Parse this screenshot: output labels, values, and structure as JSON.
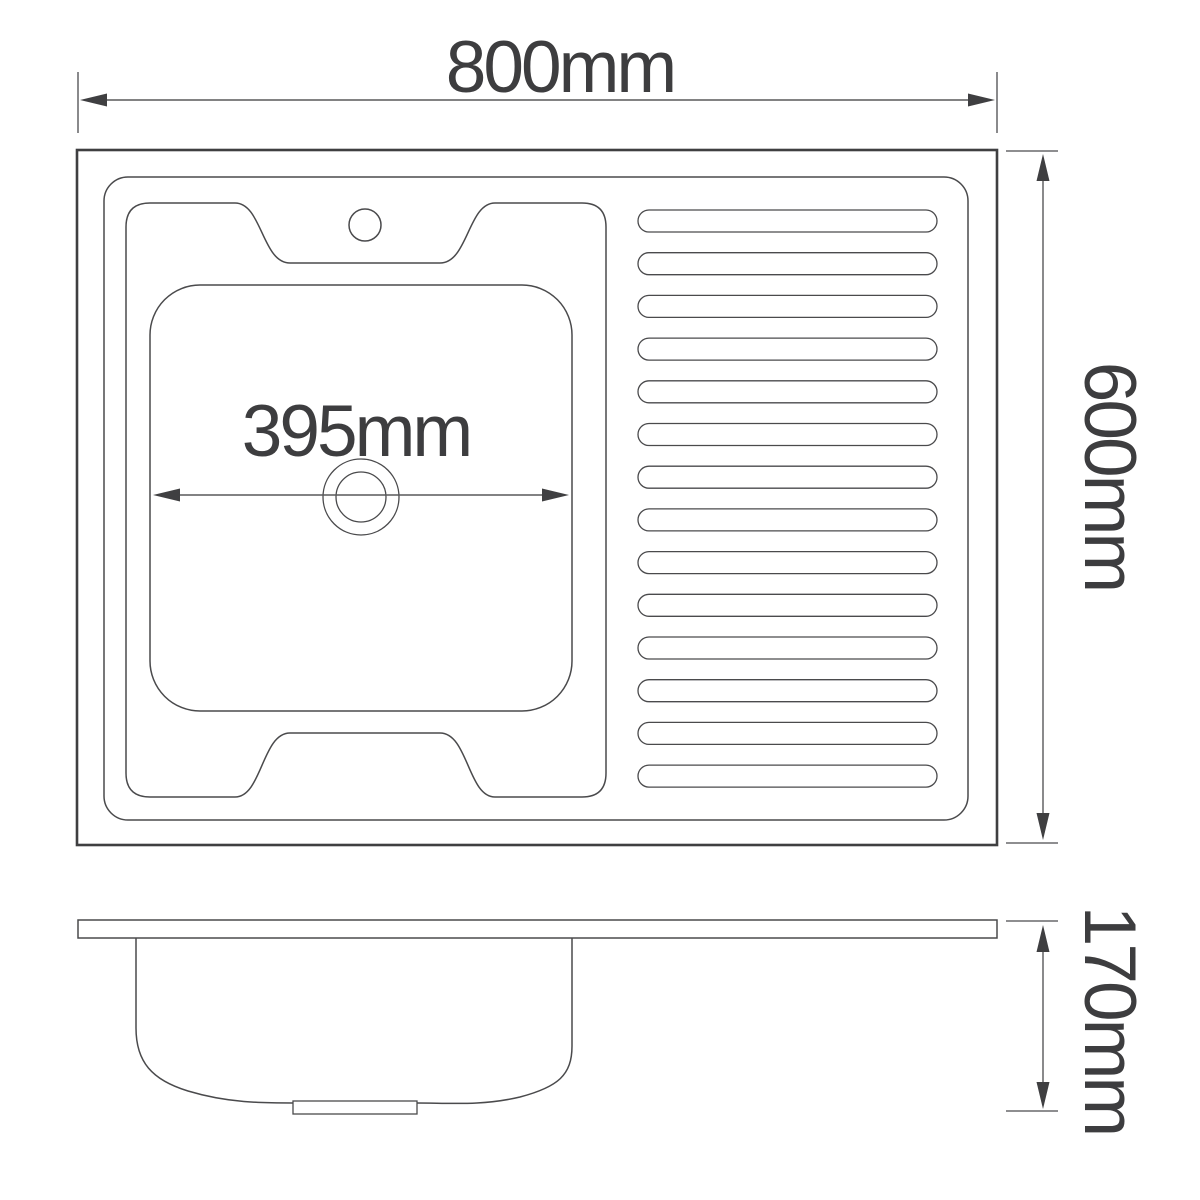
{
  "drawing": {
    "type": "kitchen-sink-dimension-diagram",
    "views": {
      "top_view": {
        "description": "plan view of sink with left bowl and right drainboard",
        "drainboard_rib_count": 14,
        "faucet_hole_count": 1
      },
      "side_view": {
        "description": "front section view showing bowl depth and drain stub"
      }
    },
    "dimensions": {
      "overall_width": {
        "label": "800mm",
        "value": 800,
        "unit": "mm"
      },
      "overall_depth": {
        "label": "600mm",
        "value": 600,
        "unit": "mm"
      },
      "bowl_width": {
        "label": "395mm",
        "value": 395,
        "unit": "mm"
      },
      "bowl_depth": {
        "label": "170mm",
        "value": 170,
        "unit": "mm"
      }
    },
    "colors": {
      "background": "#ffffff",
      "outline": "#4a4a4c",
      "outline_heavy": "#3f3f41",
      "dimension_line": "#58585a",
      "extension_line": "#7e7e80",
      "text": "#3d3d3f"
    }
  }
}
